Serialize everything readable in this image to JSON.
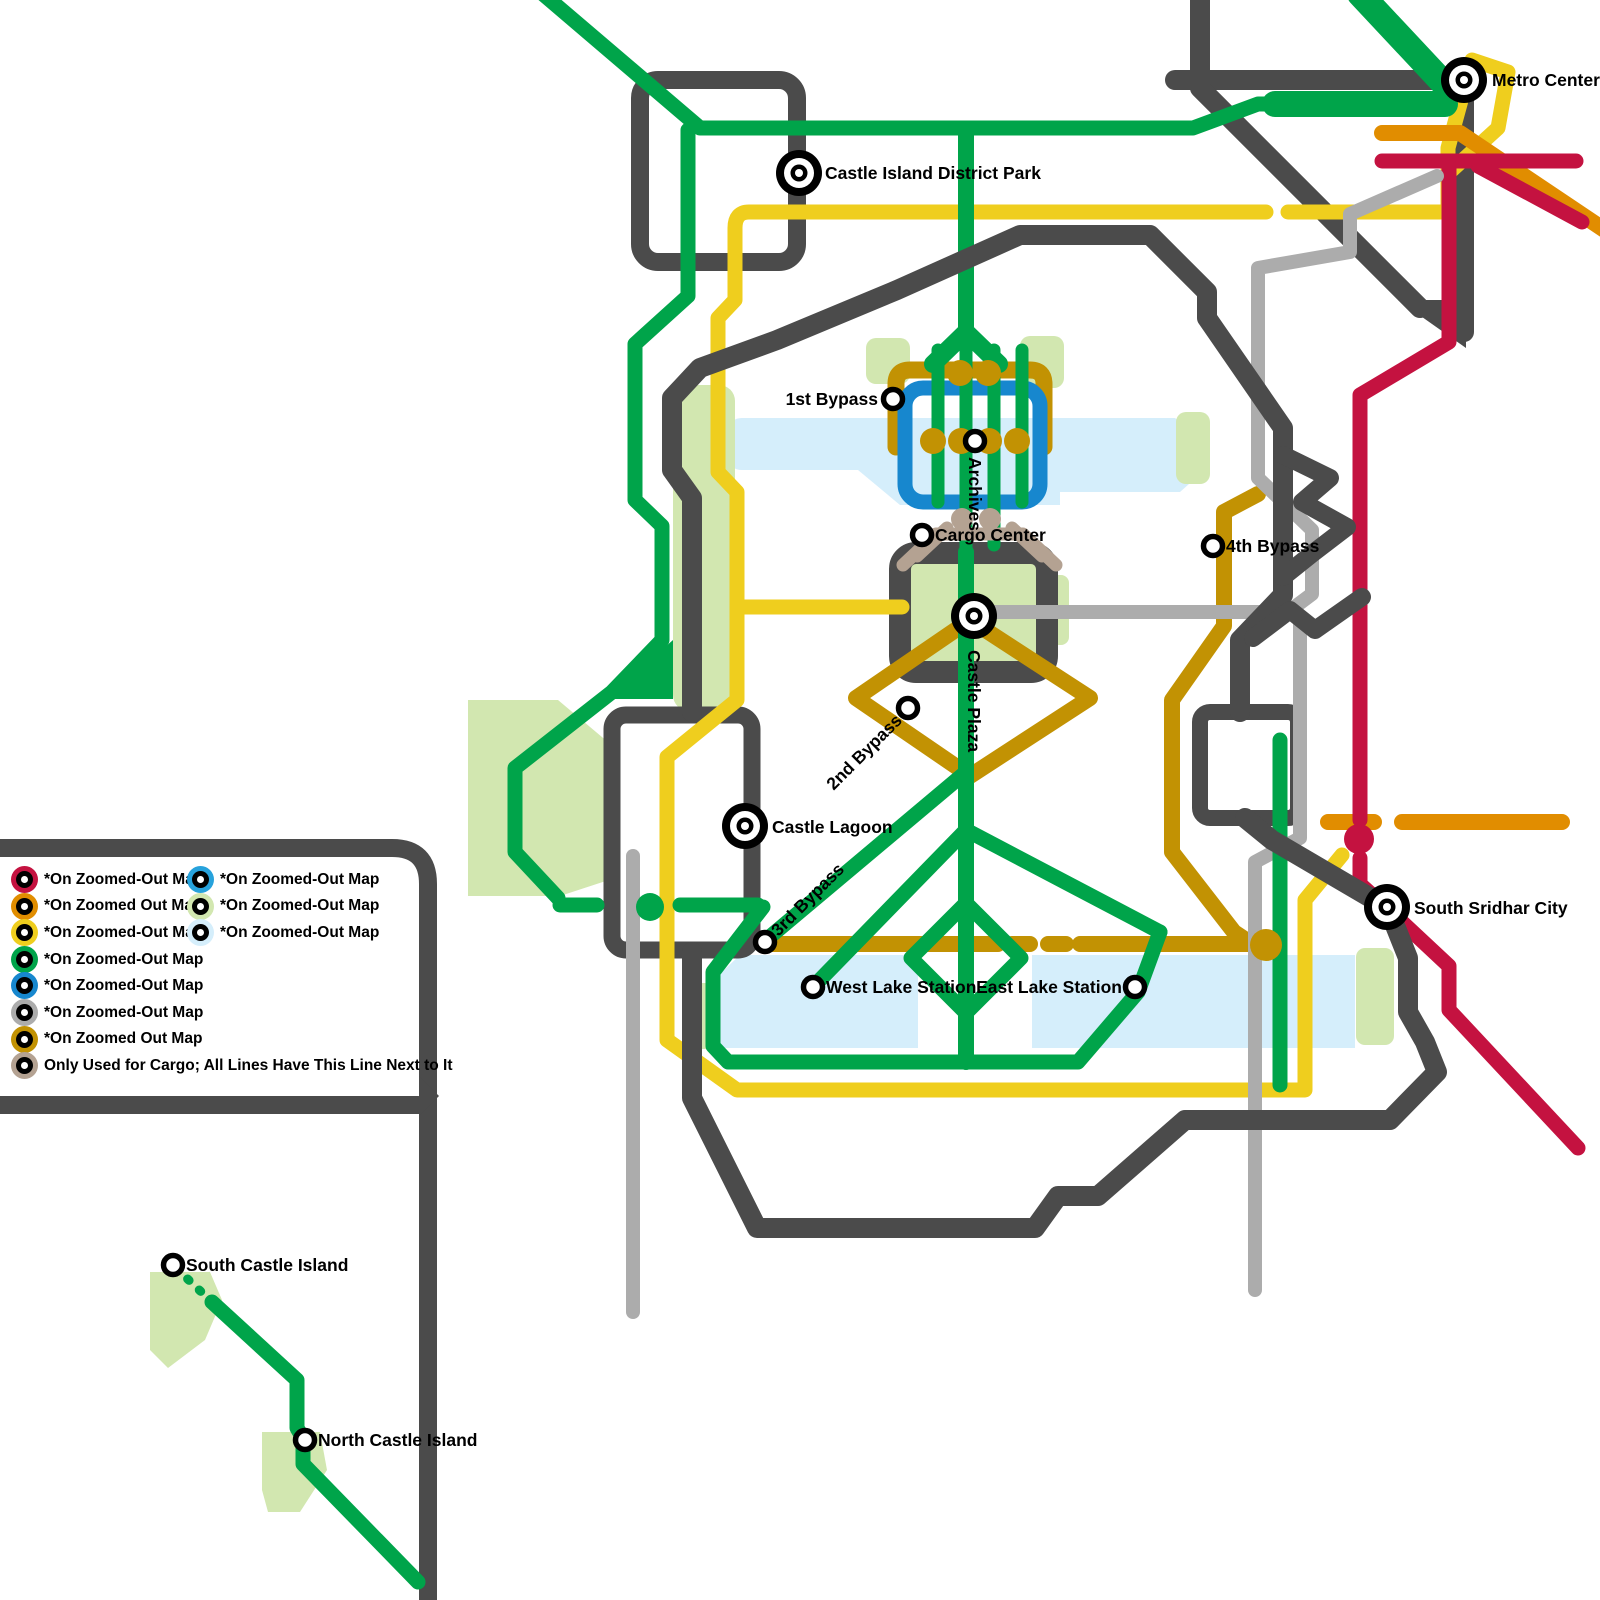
{
  "colors": {
    "crimson": "#C41240",
    "orange": "#E18D00",
    "yellow": "#EFCE1E",
    "green": "#00A44A",
    "blue": "#1787CE",
    "blue2": "#27A2DC",
    "gray": "#ACACAC",
    "gold": "#C29203",
    "tan": "#B4A292",
    "dark": "#4B4B4B",
    "water": "#D5EEFB",
    "park": "#D2E7B0"
  },
  "legend": {
    "left_items": [
      {
        "color": "crimson",
        "label": "*On Zoomed-Out Map"
      },
      {
        "color": "orange",
        "label": "*On Zoomed Out Map"
      },
      {
        "color": "yellow",
        "label": "*On Zoomed-Out Map"
      },
      {
        "color": "green",
        "label": "*On Zoomed-Out Map"
      },
      {
        "color": "blue",
        "label": "*On Zoomed-Out Map"
      },
      {
        "color": "gray",
        "label": "*On Zoomed-Out Map"
      },
      {
        "color": "gold",
        "label": "*On Zoomed Out Map"
      },
      {
        "color": "tan",
        "label": "Only Used for Cargo; All Lines Have This Line Next to It"
      }
    ],
    "right_items": [
      {
        "color": "blue2",
        "label": "*On Zoomed-Out Map"
      },
      {
        "color": "park",
        "label": "*On Zoomed-Out Map"
      },
      {
        "color": "water",
        "label": "*On Zoomed-Out Map"
      }
    ]
  },
  "stations": [
    {
      "id": "metro-center",
      "name": "Metro Center",
      "x": 1464,
      "y": 80,
      "size": "l",
      "dx": 28,
      "dy": 6,
      "anchor": "start",
      "rotate": 0
    },
    {
      "id": "castle-island-district-park",
      "name": "Castle Island District Park",
      "x": 799,
      "y": 173,
      "size": "l",
      "dx": 26,
      "dy": 6,
      "anchor": "start",
      "rotate": 0
    },
    {
      "id": "first-bypass",
      "name": "1st Bypass",
      "x": 893,
      "y": 399,
      "size": "s",
      "dx": -15,
      "dy": 6,
      "anchor": "end",
      "rotate": 0
    },
    {
      "id": "archives",
      "name": "Archives",
      "x": 975,
      "y": 441,
      "size": "s",
      "dx": 16,
      "dy": 6,
      "anchor": "start",
      "rotate": 90
    },
    {
      "id": "cargo-center",
      "name": "Cargo Center",
      "x": 922,
      "y": 535,
      "size": "s",
      "dx": 13,
      "dy": 6,
      "anchor": "start",
      "rotate": 0
    },
    {
      "id": "fourth-bypass",
      "name": "4th Bypass",
      "x": 1213,
      "y": 546,
      "size": "s",
      "dx": 13,
      "dy": 6,
      "anchor": "start",
      "rotate": 0
    },
    {
      "id": "castle-plaza",
      "name": "Castle Plaza",
      "x": 974,
      "y": 616,
      "size": "l",
      "dx": 34,
      "dy": 6,
      "anchor": "start",
      "rotate": 90
    },
    {
      "id": "second-bypass",
      "name": "2nd Bypass",
      "x": 908,
      "y": 708,
      "size": "s",
      "dx": -13,
      "dy": 6,
      "anchor": "end",
      "rotate": -45
    },
    {
      "id": "castle-lagoon",
      "name": "Castle Lagoon",
      "x": 745,
      "y": 826,
      "size": "l",
      "dx": 27,
      "dy": 7,
      "anchor": "start",
      "rotate": 0
    },
    {
      "id": "third-bypass",
      "name": "3rd Bypass",
      "x": 765,
      "y": 942,
      "size": "s",
      "dx": 13,
      "dy": 6,
      "anchor": "start",
      "rotate": -45
    },
    {
      "id": "west-lake-station",
      "name": "West Lake Station",
      "x": 813,
      "y": 987,
      "size": "s",
      "dx": 13,
      "dy": 6,
      "anchor": "start",
      "rotate": 0
    },
    {
      "id": "east-lake-station",
      "name": "East Lake Station",
      "x": 1135,
      "y": 987,
      "size": "s",
      "dx": -13,
      "dy": 6,
      "anchor": "end",
      "rotate": 0
    },
    {
      "id": "south-sridhar-city",
      "name": "South Sridhar City",
      "x": 1387,
      "y": 907,
      "size": "l",
      "dx": 27,
      "dy": 7,
      "anchor": "start",
      "rotate": 0
    },
    {
      "id": "south-castle-island",
      "name": "South Castle Island",
      "x": 173,
      "y": 1265,
      "size": "s",
      "dx": 13,
      "dy": 6,
      "anchor": "start",
      "rotate": 0
    },
    {
      "id": "north-castle-island",
      "name": "North Castle Island",
      "x": 305,
      "y": 1440,
      "size": "s",
      "dx": 13,
      "dy": 6,
      "anchor": "start",
      "rotate": 0
    }
  ]
}
